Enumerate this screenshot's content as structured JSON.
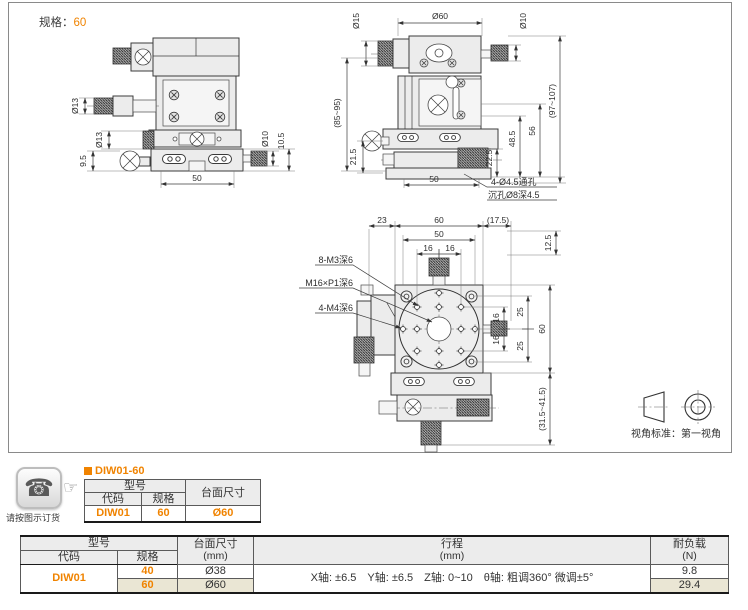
{
  "drawing_area": {
    "spec_label": "规格：",
    "spec_value": "60",
    "view_standard_label": "视角标准：",
    "view_standard_value": "第一视角"
  },
  "side_view": {
    "dia13_upper": "Ø13",
    "dia13_lower": "Ø13",
    "dim_9_5": "9.5",
    "dim_50": "50",
    "dia10": "Ø10",
    "dim_10_5": "10.5"
  },
  "front_view": {
    "dia15": "Ø15",
    "dia60": "Ø60",
    "dia10": "Ø10",
    "height_range_left": "(85~95)",
    "dim_21_5": "21.5",
    "dim_50": "50",
    "dim_22_5": "22.5",
    "dim_48_5": "48.5",
    "dim_56": "56",
    "height_range_right": "(97~107)",
    "note_through_hole": "4-Ø4.5通孔",
    "note_counterbore": "沉孔Ø8深4.5"
  },
  "top_view": {
    "dim_23": "23",
    "dim_60_top": "60",
    "dim_50": "50",
    "dim_16_a": "16",
    "dim_16_b": "16",
    "dim_17_5": "(17.5)",
    "dim_12_5": "12.5",
    "dim_16_c": "16",
    "dim_16_d": "16",
    "dim_25_a": "25",
    "dim_25_b": "25",
    "dim_60_right": "60",
    "dim_range_bottom": "(31.5~41.5)",
    "note_m3": "8-M3深6",
    "note_m16": "M16×P1深6",
    "note_m4": "4-M4深6"
  },
  "order_block": {
    "phone_note": "请按图示订货",
    "part_number": "DIW01-60",
    "table": {
      "header_model": "型号",
      "header_code": "代码",
      "header_spec": "规格",
      "header_size": "台面尺寸",
      "code": "DIW01",
      "spec": "60",
      "size": "Ø60"
    }
  },
  "spec_table": {
    "header_model": "型号",
    "header_code": "代码",
    "header_spec": "规格",
    "header_size_line1": "台面尺寸",
    "header_size_line2": "(mm)",
    "header_travel_line1": "行程",
    "header_travel_line2": "(mm)",
    "header_load_line1": "耐负载",
    "header_load_line2": "(N)",
    "code": "DIW01",
    "travel": "X轴: ±6.5　Y轴: ±6.5　Z轴: 0~10　θ轴: 粗调360°  微调±5°",
    "rows": [
      {
        "spec": "40",
        "size": "Ø38",
        "load": "9.8"
      },
      {
        "spec": "60",
        "size": "Ø60",
        "load": "29.4"
      }
    ]
  },
  "colors": {
    "accent": "#f08300",
    "row_highlight": "#eae6d4",
    "header_bg": "#ececec"
  }
}
